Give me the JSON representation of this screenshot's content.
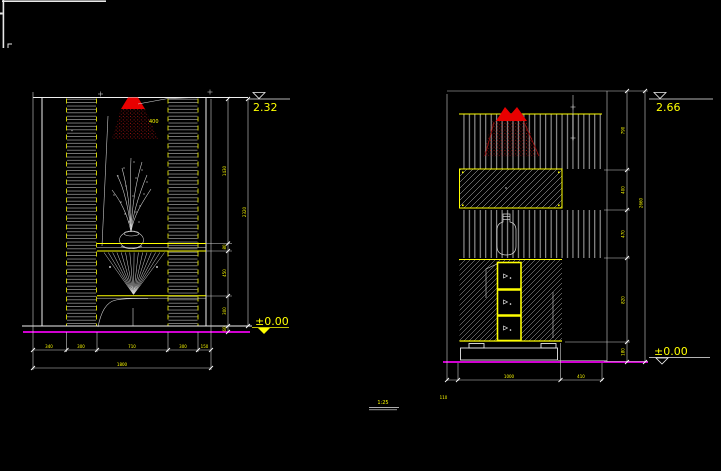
{
  "colors": {
    "background": "#000000",
    "linework": "#e8e8e8",
    "dimension_text": "#ffff00",
    "floor_line": "#ff00ff",
    "spotlight": "#ff0000"
  },
  "left_view": {
    "elevation_top": "2.32",
    "elevation_floor": "±0.00",
    "light_label": "400",
    "vertical_dims": [
      "1430",
      "80",
      "450",
      "300",
      "60"
    ],
    "vertical_total": "2320",
    "horizontal_dims": [
      "340",
      "300",
      "710",
      "300",
      "150"
    ],
    "horizontal_total": "1800"
  },
  "right_view": {
    "elevation_top": "2.66",
    "elevation_floor": "±0.00",
    "vertical_dims": [
      "790",
      "400",
      "470",
      "820",
      "180"
    ],
    "vertical_total": "2660",
    "horizontal_dims": [
      "1000",
      "410"
    ],
    "horizontal_offset": "110"
  },
  "footer": {
    "scale_label": "1:25"
  }
}
